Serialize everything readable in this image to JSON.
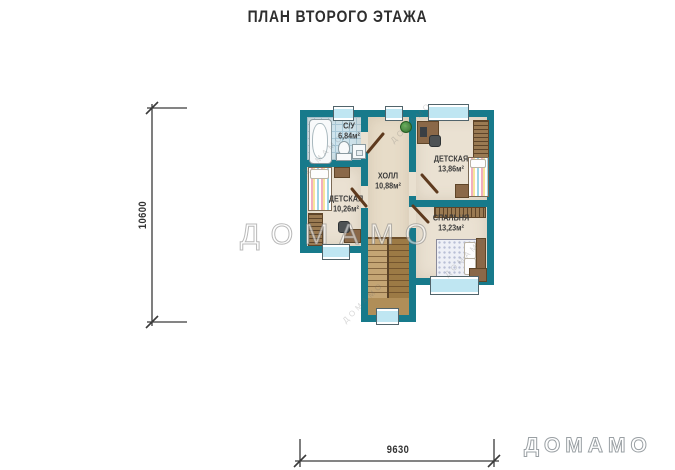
{
  "title": "ПЛАН ВТОРОГО ЭТАЖА",
  "dimensions": {
    "vertical": "10600",
    "horizontal": "9630"
  },
  "rooms": [
    {
      "id": "bathroom",
      "name": "С/У",
      "area": "6,84м²"
    },
    {
      "id": "hall",
      "name": "ХОЛЛ",
      "area": "10,88м²"
    },
    {
      "id": "nursery-right",
      "name": "ДЕТСКАЯ",
      "area": "13,86м²"
    },
    {
      "id": "nursery-left",
      "name": "ДЕТСКАЯ",
      "area": "10,26м²"
    },
    {
      "id": "bedroom",
      "name": "СПАЛЬНЯ",
      "area": "13,23м²"
    }
  ],
  "watermarks": {
    "center": "ДОМАМО",
    "corner": "ДОМАМО",
    "tile": "ДОМАМО"
  },
  "colors": {
    "wall": "#177a8b",
    "room_floor": "#eae1d2",
    "hall_floor": "#e7dcc8",
    "bath_tile": "#cfe4ed",
    "window_glass": "#bfe6f2",
    "stair_wood_light": "#c4a574",
    "stair_wood_dark": "#9c7a45",
    "door_leaf": "#5e3a1e",
    "dimension_line": "#3a3a3a"
  }
}
